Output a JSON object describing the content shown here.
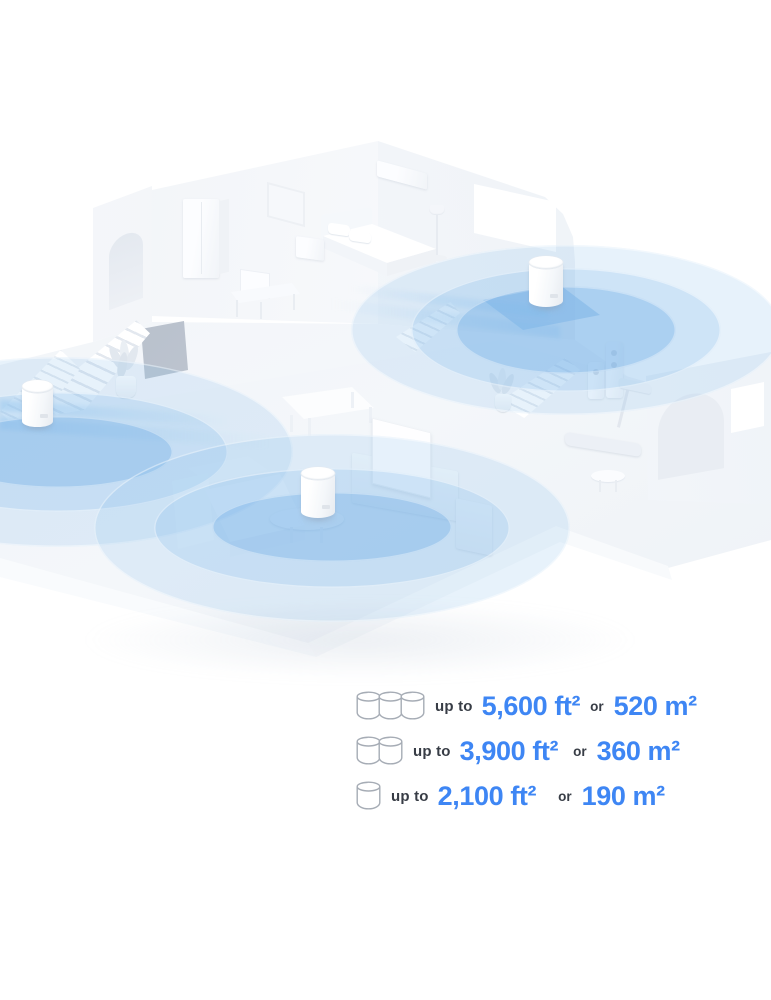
{
  "coverage": {
    "rows": [
      {
        "units": 3,
        "prefix": "up to",
        "imperial": "5,600 ft²",
        "conjunction": "or",
        "metric": "520 m²"
      },
      {
        "units": 2,
        "prefix": "up to",
        "imperial": "3,900 ft²",
        "conjunction": "or",
        "metric": "360 m²"
      },
      {
        "units": 1,
        "prefix": "up to",
        "imperial": "2,100 ft²",
        "conjunction": "or",
        "metric": "190 m²"
      }
    ]
  },
  "illustration": {
    "deco_units_visible": 3,
    "wifi_ripple_sets": 3
  },
  "colors": {
    "accent_blue": "#3E86F4",
    "label_dark": "#383D46",
    "ripple_blue": "#8FBFE9"
  }
}
